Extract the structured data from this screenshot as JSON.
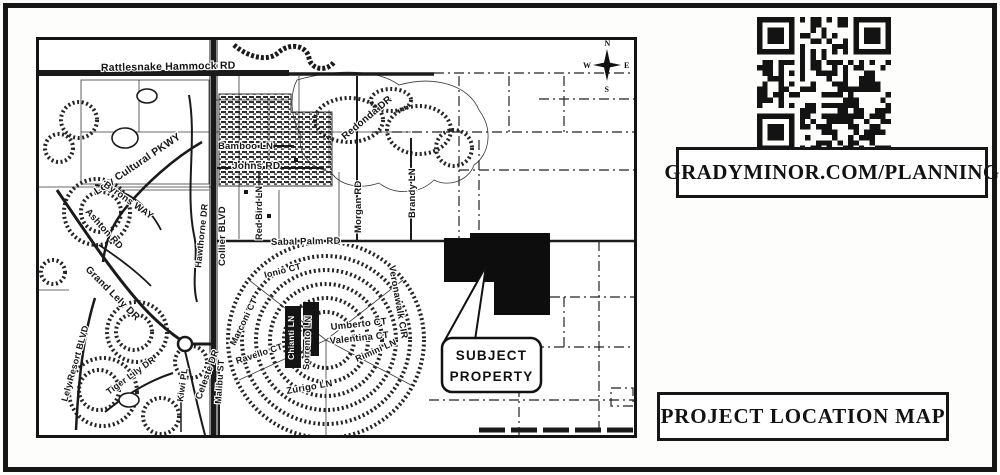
{
  "annotation": {
    "qr_caption": "GRADYMINOR.COM/PLANNING",
    "map_title": "PROJECT LOCATION MAP"
  },
  "callout": {
    "line1": "SUBJECT",
    "line2": "PROPERTY"
  },
  "compass": {
    "n": "N",
    "e": "E",
    "s": "S",
    "w": "W"
  },
  "colors": {
    "ink": "#1a1a1a",
    "paper": "#ffffff"
  },
  "map": {
    "labels": [
      {
        "text": "Rattlesnake Hammock RD",
        "x": 62,
        "y": 31,
        "r": -1,
        "s": 10.5
      },
      {
        "text": "Bamboo LN",
        "x": 179,
        "y": 109,
        "r": 0,
        "s": 9.5
      },
      {
        "text": "Johns RD",
        "x": 193,
        "y": 129,
        "r": 0,
        "s": 10
      },
      {
        "text": "Lely Cultural PKWY",
        "x": 58,
        "y": 155,
        "r": -34,
        "s": 10.5
      },
      {
        "text": "Redonda DR",
        "x": 306,
        "y": 100,
        "r": -40,
        "s": 10
      },
      {
        "text": "Collier BLVD",
        "x": 186,
        "y": 226,
        "r": -90,
        "s": 9.5
      },
      {
        "text": "Hawthorne DR",
        "x": 162,
        "y": 228,
        "r": -84,
        "s": 9
      },
      {
        "text": "Red Bird LN",
        "x": 223,
        "y": 200,
        "r": -90,
        "s": 9
      },
      {
        "text": "Morgan RD",
        "x": 322,
        "y": 193,
        "r": -90,
        "s": 9.5
      },
      {
        "text": "Brandy LN",
        "x": 376,
        "y": 178,
        "r": -90,
        "s": 9.5
      },
      {
        "text": "Sabal Palm RD",
        "x": 232,
        "y": 205,
        "r": -1,
        "s": 9.5
      },
      {
        "text": "Veronawalk CIR",
        "x": 350,
        "y": 226,
        "r": 80,
        "s": 9.5
      },
      {
        "text": "Ashton RD",
        "x": 46,
        "y": 172,
        "r": 48,
        "s": 9.5
      },
      {
        "text": "Byrons WAY",
        "x": 64,
        "y": 146,
        "r": 35,
        "s": 9.5
      },
      {
        "text": "Grand Lely DR",
        "x": 46,
        "y": 230,
        "r": 45,
        "s": 10
      },
      {
        "text": "Lely Resort BLVD",
        "x": 28,
        "y": 362,
        "r": -74,
        "s": 9
      },
      {
        "text": "Tiger Lily DR",
        "x": 70,
        "y": 355,
        "r": -36,
        "s": 9
      },
      {
        "text": "Kiwi PL",
        "x": 144,
        "y": 362,
        "r": -82,
        "s": 9
      },
      {
        "text": "Celeste DR",
        "x": 162,
        "y": 360,
        "r": -70,
        "s": 9.5
      },
      {
        "text": "Malibu ST",
        "x": 182,
        "y": 364,
        "r": -86,
        "s": 9
      },
      {
        "text": "Ravello CT",
        "x": 198,
        "y": 324,
        "r": -18,
        "s": 9
      },
      {
        "text": "Zurigo LN",
        "x": 248,
        "y": 354,
        "r": -10,
        "s": 9.5
      },
      {
        "text": "Sorrento LN",
        "x": 270,
        "y": 330,
        "r": -88,
        "s": 9
      },
      {
        "text": "Ionio CT",
        "x": 226,
        "y": 238,
        "r": -14,
        "s": 9
      },
      {
        "text": "Marconi CT",
        "x": 196,
        "y": 306,
        "r": -64,
        "s": 9
      },
      {
        "text": "Umberto CT",
        "x": 292,
        "y": 290,
        "r": -6,
        "s": 9.5
      },
      {
        "text": "Valentina CT",
        "x": 291,
        "y": 304,
        "r": -6,
        "s": 9.5
      },
      {
        "text": "Rimini LN",
        "x": 318,
        "y": 322,
        "r": -24,
        "s": 9
      },
      {
        "text": "Chianti LN",
        "x": 255,
        "y": 320,
        "r": -90,
        "s": 8.5,
        "inv": true
      }
    ]
  }
}
